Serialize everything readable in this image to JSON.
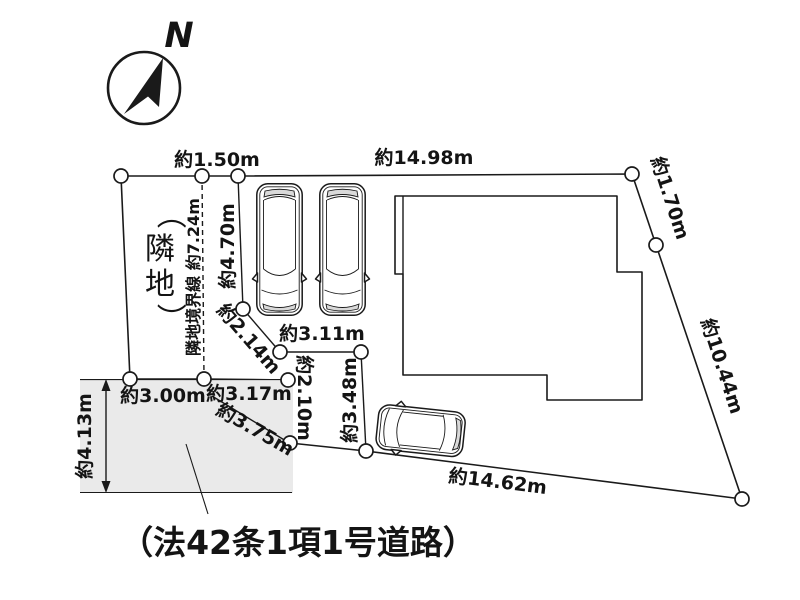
{
  "compass": {
    "north_label": "N"
  },
  "neighbor": {
    "label": "（隣地）",
    "chars": [
      "（",
      "隣",
      "地",
      "）"
    ],
    "boundary_line_label": "隣地境界線 約7.24m"
  },
  "road": {
    "label": "（法42条1項1号道路）",
    "width": "約4.13m"
  },
  "dimensions": {
    "top_offset": "約1.50m",
    "top_width": "約14.98m",
    "right_upper": "約1.70m",
    "right_lower": "約10.44m",
    "bottom_width": "約14.62m",
    "front_left": "約3.00m",
    "front_center": "約3.17m",
    "front_diagonal": "約3.75m",
    "step_vertical_left": "約2.10m",
    "step_vertical_right": "約3.48m",
    "step_diagonal": "約2.14m",
    "step_horizontal": "約3.11m",
    "left_vertical": "約4.70m"
  },
  "colors": {
    "site_fill": "#eaeaea",
    "road_fill": "#eaeaea",
    "building_fill": "#ffffff",
    "line": "#1a1a1a"
  }
}
